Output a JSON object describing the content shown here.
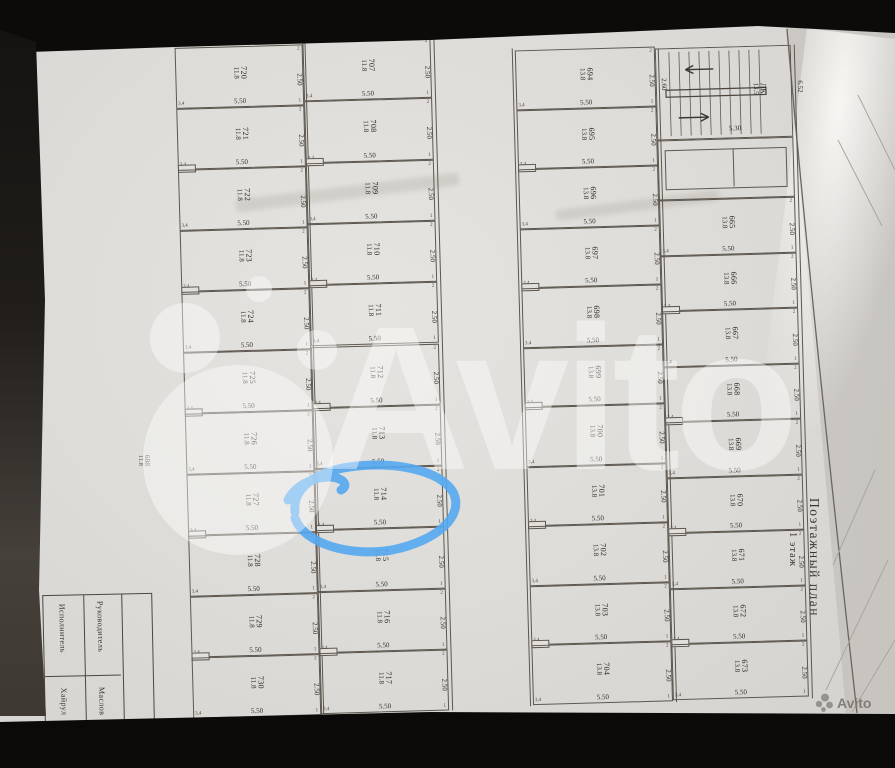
{
  "photo": {
    "watermark_text": "Avito",
    "corner_logo_text": "Avito"
  },
  "plan": {
    "vertical_title": "Поэтажный план",
    "vertical_floor": "1 этаж",
    "circled_stall": "714",
    "stall_width_dim": "5.50",
    "stall_depth_dim": "2.50",
    "ticks": {
      "top": "2",
      "bottom": "1",
      "left": "3,4"
    },
    "stair": {
      "label": "ЛК",
      "area": "13.5",
      "width_dim": "5.30",
      "depth_dim": "2.60",
      "edge_dim": "6.52"
    },
    "edge_stall": {
      "number": "688",
      "area": "11.8"
    },
    "columns": {
      "left_outer": {
        "stalls": [
          {
            "n": "720",
            "a": "11.8"
          },
          {
            "n": "721",
            "a": "11.8"
          },
          {
            "n": "722",
            "a": "11.8"
          },
          {
            "n": "723",
            "a": "11.8"
          },
          {
            "n": "724",
            "a": "11.8"
          },
          {
            "n": "725",
            "a": "11.8"
          },
          {
            "n": "726",
            "a": "11.8"
          },
          {
            "n": "727",
            "a": "11.8"
          },
          {
            "n": "728",
            "a": "11.8"
          },
          {
            "n": "729",
            "a": "11.8"
          },
          {
            "n": "730",
            "a": "11.8"
          }
        ]
      },
      "left_inner": {
        "stalls": [
          {
            "n": "707",
            "a": "11.8"
          },
          {
            "n": "708",
            "a": "11.8"
          },
          {
            "n": "709",
            "a": "11.8"
          },
          {
            "n": "710",
            "a": "11.8"
          },
          {
            "n": "711",
            "a": "11.8"
          },
          {
            "n": "712",
            "a": "11.8"
          },
          {
            "n": "713",
            "a": "11.8"
          },
          {
            "n": "714",
            "a": "11.8"
          },
          {
            "n": "715",
            "a": "11.8"
          },
          {
            "n": "716",
            "a": "11.8"
          },
          {
            "n": "717",
            "a": "11.8"
          }
        ]
      },
      "right_inner": {
        "stalls": [
          {
            "n": "694",
            "a": "13.8"
          },
          {
            "n": "695",
            "a": "13.8"
          },
          {
            "n": "696",
            "a": "13.8"
          },
          {
            "n": "697",
            "a": "13.8"
          },
          {
            "n": "698",
            "a": "13.8"
          },
          {
            "n": "699",
            "a": "13.8"
          },
          {
            "n": "700",
            "a": "13.8"
          },
          {
            "n": "701",
            "a": "13.8"
          },
          {
            "n": "702",
            "a": "13.8"
          },
          {
            "n": "703",
            "a": "13.8"
          },
          {
            "n": "704",
            "a": "13.8"
          }
        ]
      },
      "right_outer": {
        "stalls": [
          {
            "n": "665",
            "a": "13.8"
          },
          {
            "n": "666",
            "a": "13.8"
          },
          {
            "n": "667",
            "a": "13.8"
          },
          {
            "n": "668",
            "a": "13.8"
          },
          {
            "n": "669",
            "a": "13.8"
          },
          {
            "n": "670",
            "a": "13.8"
          },
          {
            "n": "671",
            "a": "13.8"
          },
          {
            "n": "672",
            "a": "13.8"
          },
          {
            "n": "673",
            "a": "13.8"
          }
        ]
      }
    },
    "title_block": {
      "col1_header": "Исполнитель",
      "col2_header": "Руководитель",
      "col1_name": "Хайрул",
      "col2_name": "Маслов"
    }
  }
}
